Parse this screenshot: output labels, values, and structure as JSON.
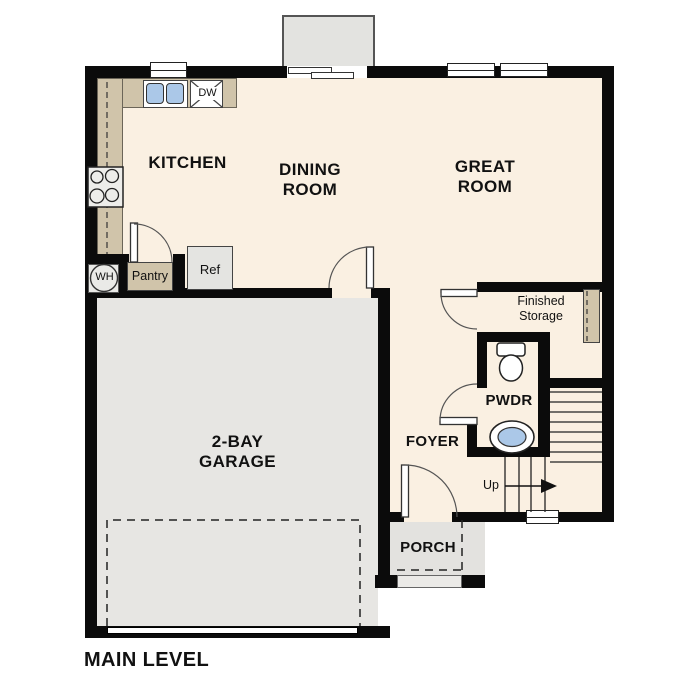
{
  "labels": {
    "kitchen": "KITCHEN",
    "dining_room": "DINING\nROOM",
    "great_room": "GREAT\nROOM",
    "garage": "2-BAY\nGARAGE",
    "foyer": "FOYER",
    "porch": "PORCH",
    "powder_room": "PWDR",
    "finished_storage": "Finished\nStorage",
    "pantry": "Pantry",
    "refrigerator": "Ref",
    "dishwasher": "DW",
    "water_heater": "WH",
    "stairs_direction": "Up",
    "title": "MAIN LEVEL"
  },
  "colors": {
    "wall": "#0b0b0b",
    "floor": "#faf0e2",
    "garage_floor": "#e7e6e3",
    "porch_floor": "#e3e2df",
    "counter": "#d0c4aa",
    "fixture_blue": "#abc8e8",
    "exterior_box": "#e3e3e0"
  }
}
